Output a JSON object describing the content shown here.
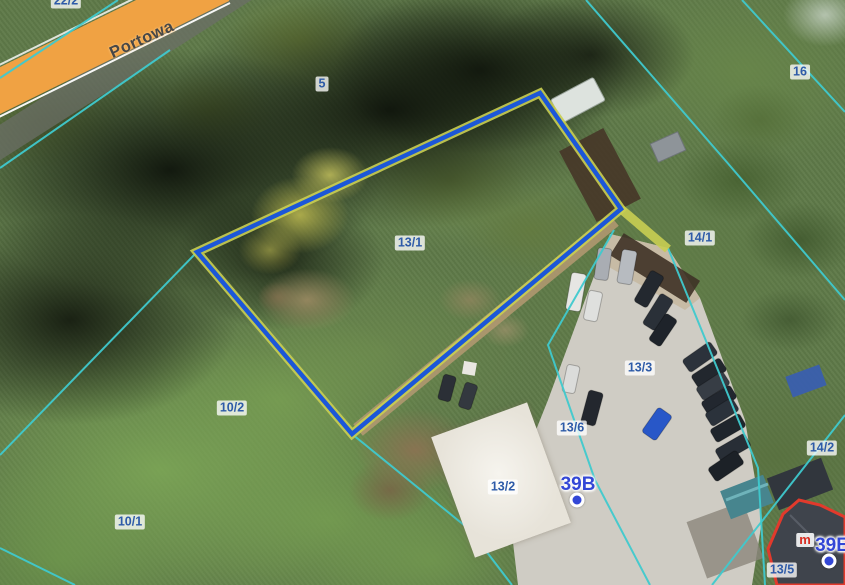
{
  "map": {
    "street": {
      "name": "Portowa"
    },
    "selected_parcel_label": "13/1",
    "parcel_labels": [
      {
        "text": "22/2",
        "x": 66,
        "y": 1
      },
      {
        "text": "5",
        "x": 322,
        "y": 84
      },
      {
        "text": "13/1",
        "x": 410,
        "y": 243
      },
      {
        "text": "14/1",
        "x": 700,
        "y": 238
      },
      {
        "text": "16",
        "x": 800,
        "y": 72
      },
      {
        "text": "13/3",
        "x": 640,
        "y": 368
      },
      {
        "text": "10/2",
        "x": 232,
        "y": 408
      },
      {
        "text": "10/1",
        "x": 130,
        "y": 522
      },
      {
        "text": "13/6",
        "x": 572,
        "y": 428
      },
      {
        "text": "13/2",
        "x": 503,
        "y": 487
      },
      {
        "text": "14/2",
        "x": 822,
        "y": 448
      },
      {
        "text": "13/5",
        "x": 782,
        "y": 570
      }
    ],
    "address_points": [
      {
        "text": "39B",
        "x": 578,
        "y": 485,
        "dot_x": 577,
        "dot_y": 500
      },
      {
        "text": "39E",
        "x": 832,
        "y": 546,
        "dot_x": 829,
        "dot_y": 561
      }
    ],
    "building_function_label": {
      "text": "m",
      "x": 805,
      "y": 540
    }
  },
  "colors": {
    "parcel_label_blue": "#2e5ba8",
    "address_blue": "#3347d6",
    "selection_blue": "#1c57d8",
    "boundary_underlay_yellow": "#c9ce52",
    "cadastral_cyan": "#3fc9cd",
    "road_orange": "#f0a243",
    "building_outline_red": "#e23a2c",
    "marker_red": "#d82c20"
  }
}
